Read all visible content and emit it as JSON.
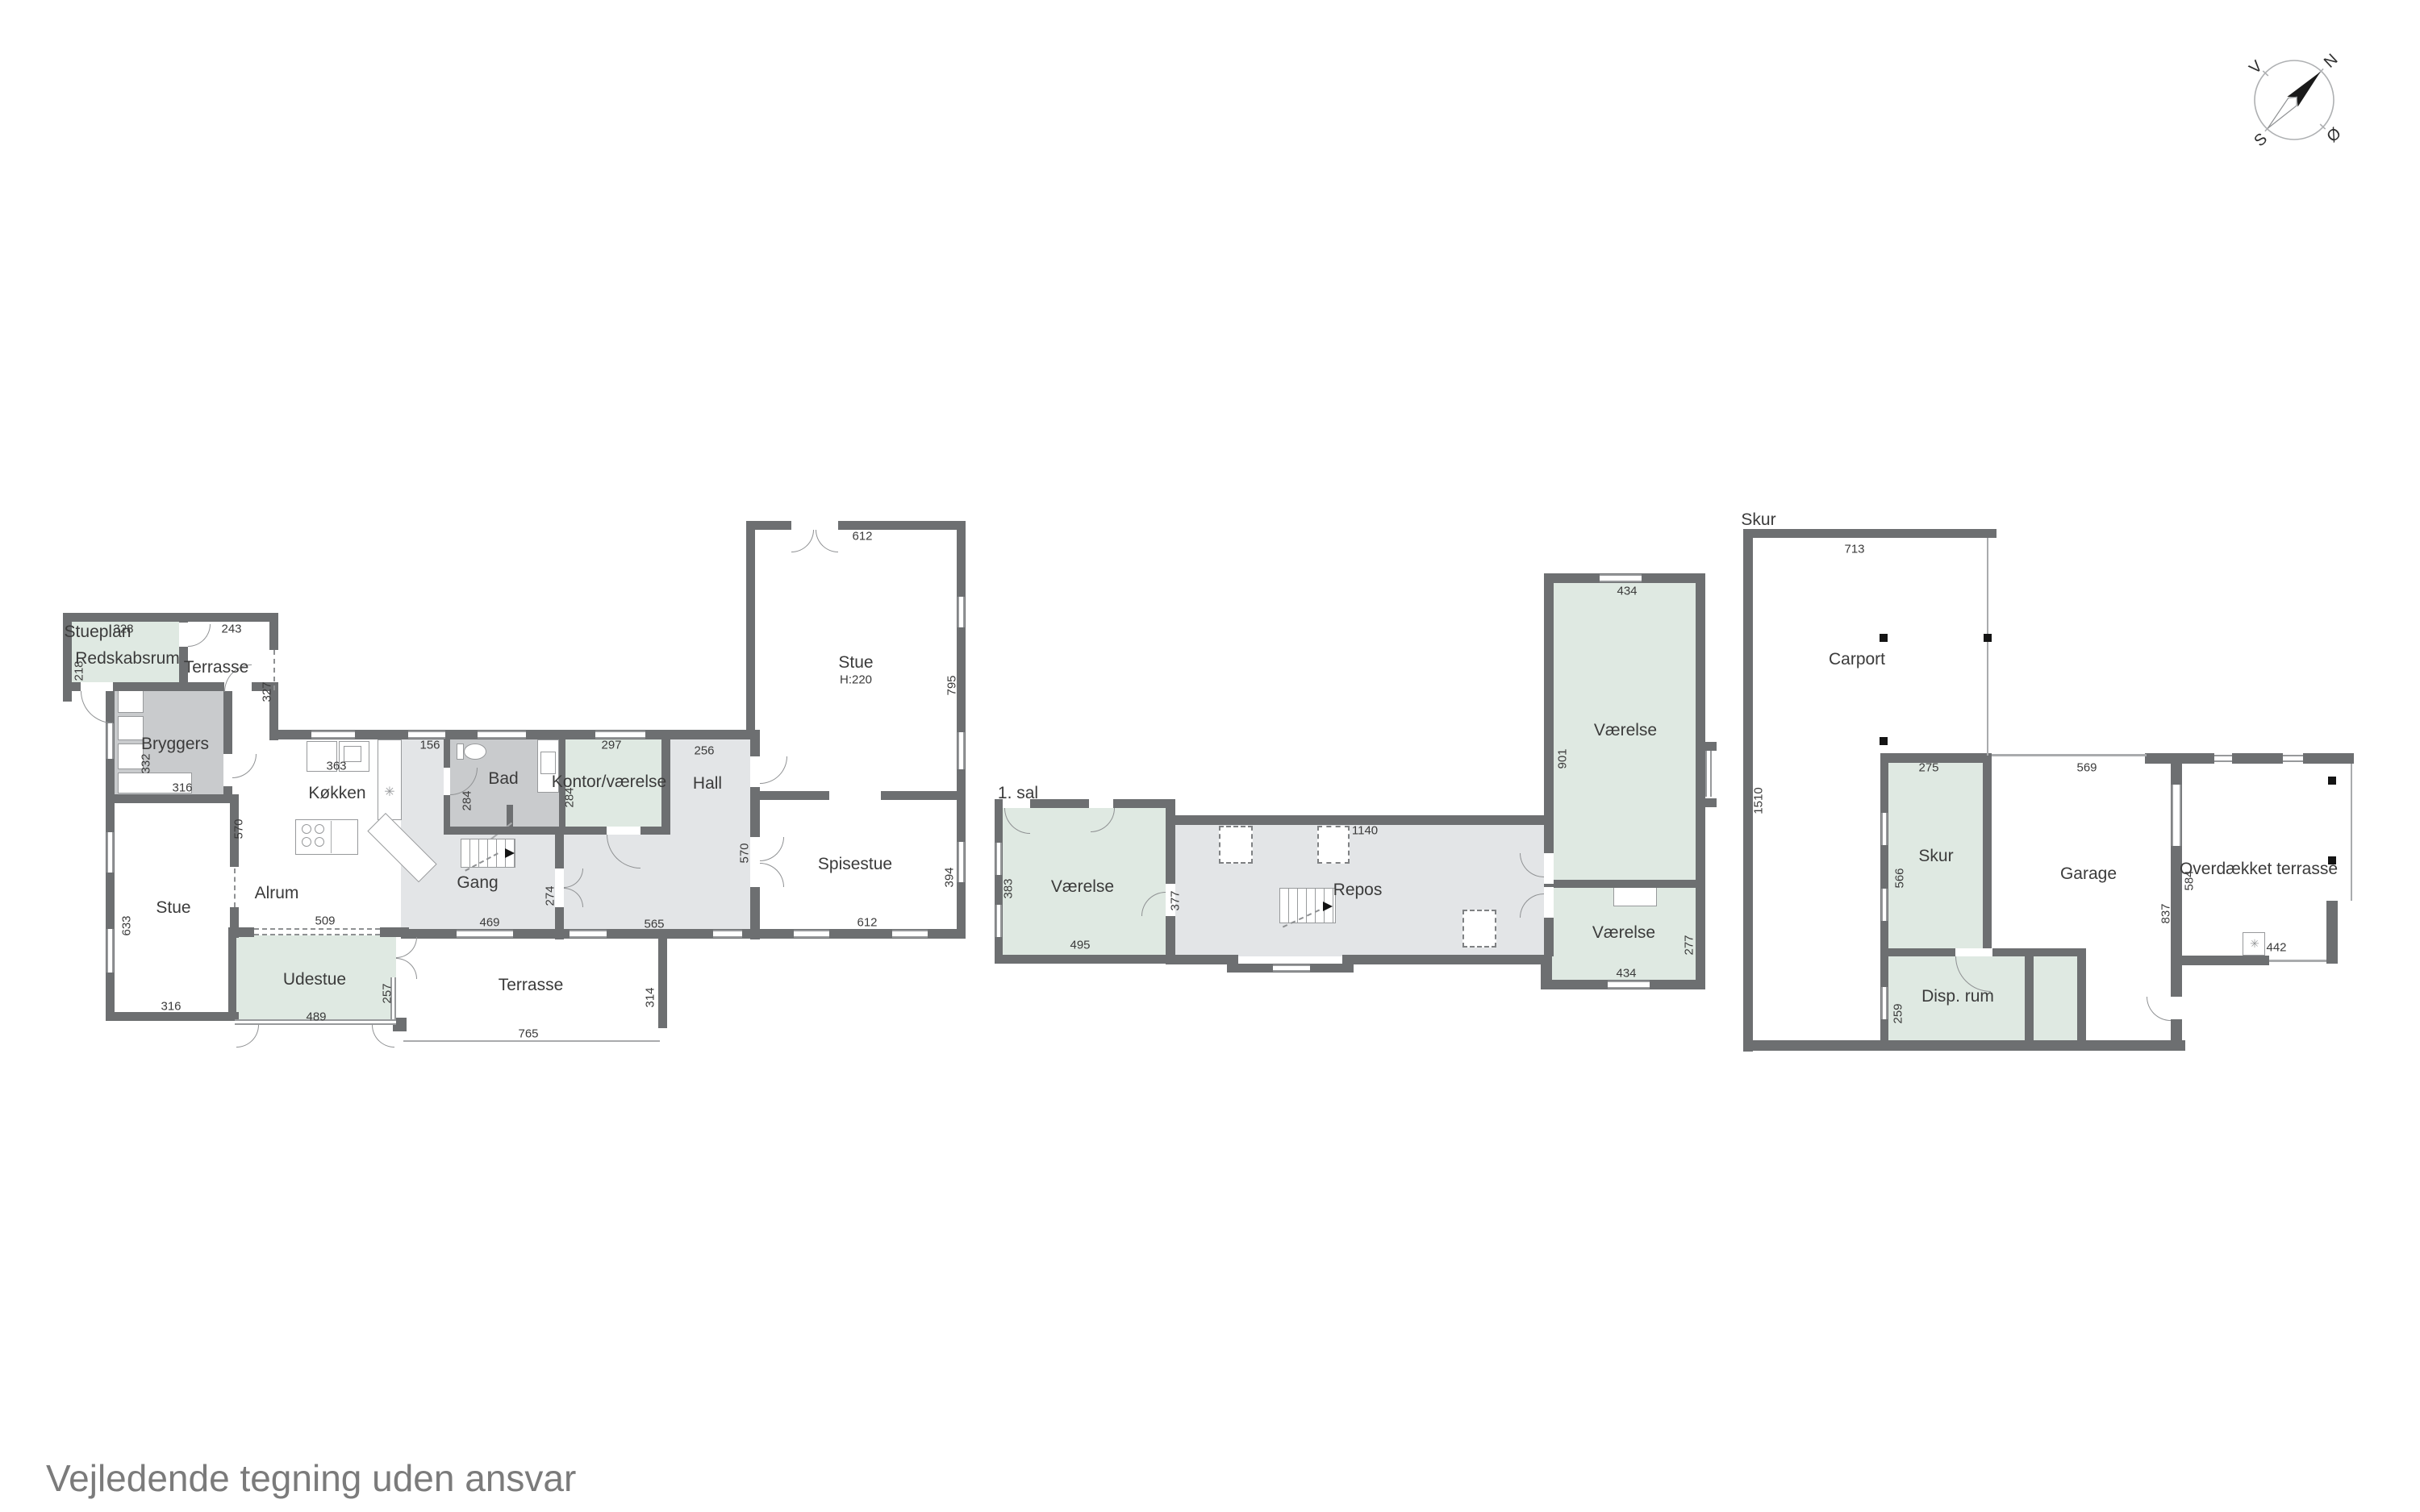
{
  "ground_floor": {
    "title": "Stueplan",
    "rooms": {
      "redskabsrum": {
        "label": "Redskabsrum",
        "dim_top": "328",
        "dim_left": "218"
      },
      "terrasse_nw": {
        "label": "Terrasse",
        "dim_top": "243",
        "dim_right": "327"
      },
      "bryggers": {
        "label": "Bryggers",
        "dim_left": "332",
        "dim_bottom": "316"
      },
      "stue_sw": {
        "label": "Stue",
        "dim_left": "633",
        "dim_bottom": "316"
      },
      "alrum": {
        "label": "Alrum",
        "dim_partition": "570"
      },
      "koekken": {
        "label": "Køkken",
        "dim_top": "363",
        "dim_wall": "156"
      },
      "udestue": {
        "label": "Udestue",
        "dim_top": "509",
        "dim_bottom": "489",
        "dim_right": "257"
      },
      "gang": {
        "label": "Gang",
        "dim_bottom": "469",
        "dim_right": "274"
      },
      "bad": {
        "label": "Bad",
        "dim_left": "284"
      },
      "kontor": {
        "label": "Kontor/værelse",
        "dim_top": "297",
        "dim_left": "284"
      },
      "hall": {
        "label": "Hall",
        "dim_top": "256",
        "dim_right": "570",
        "dim_bottom": "565"
      },
      "stue_e": {
        "label": "Stue",
        "height_note": "H:220",
        "dim_top": "612",
        "dim_right": "795"
      },
      "spisestue": {
        "label": "Spisestue",
        "dim_right": "394",
        "dim_bottom": "612"
      },
      "terrasse_s": {
        "label": "Terrasse",
        "dim_bottom": "765",
        "dim_right": "314"
      }
    }
  },
  "first_floor": {
    "title": "1. sal",
    "rooms": {
      "vaerelse_w": {
        "label": "Værelse",
        "dim_left": "383",
        "dim_bottom": "495",
        "dim_right": "377"
      },
      "repos": {
        "label": "Repos",
        "dim_top": "1140"
      },
      "vaerelse_n": {
        "label": "Værelse",
        "dim_top": "434",
        "dim_left": "901"
      },
      "vaerelse_s": {
        "label": "Værelse",
        "dim_right": "277",
        "dim_bottom": "434"
      }
    }
  },
  "outbuilding": {
    "title": "Skur",
    "left_wall_dim": "1510",
    "rooms": {
      "carport": {
        "label": "Carport",
        "dim_top": "713"
      },
      "skur": {
        "label": "Skur",
        "dim_top": "275",
        "dim_left": "566"
      },
      "garage": {
        "label": "Garage",
        "dim_top": "569",
        "dim_right": "837"
      },
      "disp_rum": {
        "label": "Disp. rum",
        "dim_left": "259"
      },
      "overdaekket_terrasse": {
        "label": "Overdækket terrasse",
        "dim_left": "584",
        "dim_bottom": "442"
      }
    }
  },
  "compass": {
    "n": "N",
    "e": "Ø",
    "s": "S",
    "w": "V"
  },
  "footer": "Vejledende tegning uden ansvar"
}
